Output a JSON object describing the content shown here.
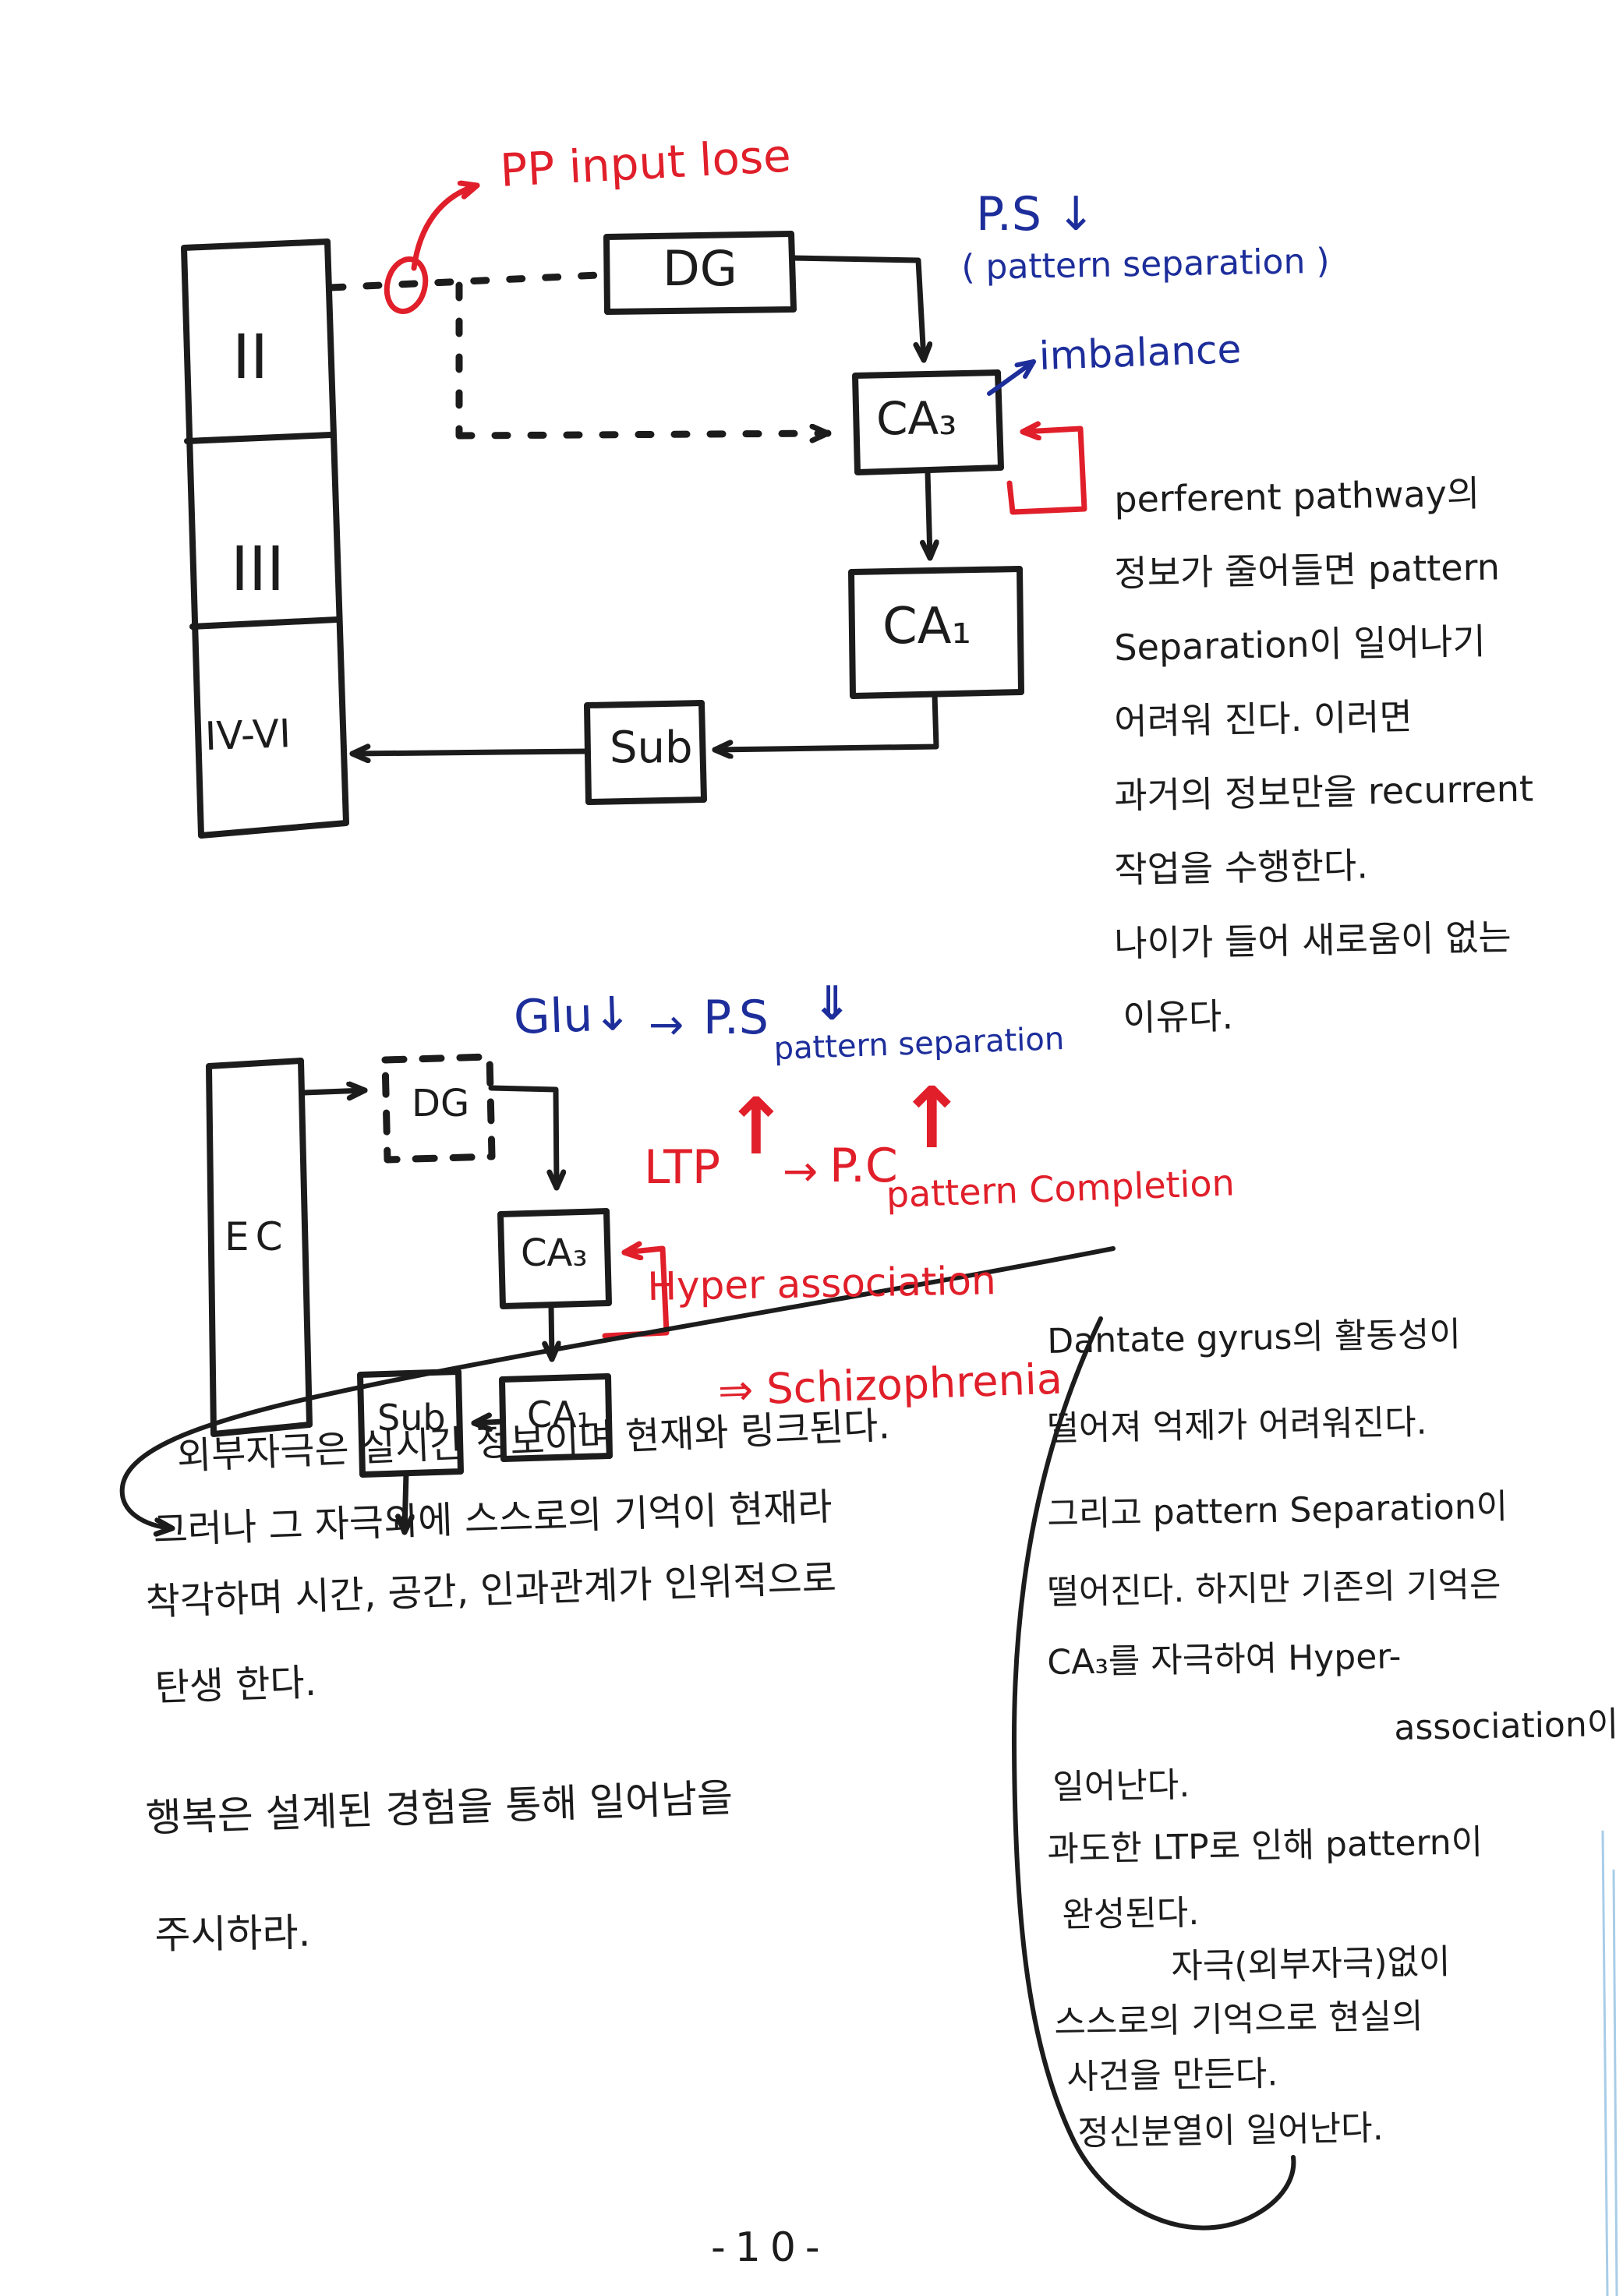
{
  "page": {
    "number": "-10-",
    "paper_color": "#ffffff",
    "ink_color": "#1c1c1c",
    "red_color": "#e01f2a",
    "blue_color": "#1d2e9b",
    "edge_line_color": "#a8cde8"
  },
  "diagram1": {
    "cortex_box": {
      "layer_2": "II",
      "layer_3": "III",
      "layer_4_6": "IV-VI"
    },
    "dg": "DG",
    "ca3": "CA₃",
    "ca1": "CA₁",
    "sub": "Sub",
    "pp_input_lose": "PP input lose",
    "ps_down": "P.S ↓",
    "pattern_separation_paren": "( pattern separation )",
    "imbalance": "imbalance"
  },
  "diagram2": {
    "ec": "EC",
    "dg": "DG",
    "ca3": "CA₃",
    "ca1": "CA₁",
    "sub": "Sub",
    "glu_down": "Glu↓",
    "arrow_right_1": "→",
    "ps": "P.S",
    "ps_double_down": "⇓",
    "pattern_separation_label": "pattern separation",
    "ltp": "LTP",
    "ltp_up_arrow": "↑",
    "arrow_right_2": "→",
    "pc": "P.C",
    "pc_up_arrow": "↑",
    "pattern_completion_label": "pattern Completion",
    "hyper_association": "Hyper association",
    "schizophrenia": "⇒ Schizophrenia"
  },
  "notes": {
    "right_top": [
      "perferent pathway의",
      "정보가 줄어들면 pattern",
      "Separation이 일어나기",
      "어려워 진다.   이러면",
      "과거의 정보만을 recurrent",
      "작업을 수행한다.",
      "나이가 들어 새로움이 없는",
      "이유다."
    ],
    "left_callout": [
      "외부자극은 실시간 정보이며 현재와 링크된다.",
      "그러나 그 자극외에 스스로의 기억이 현재라",
      "착각하며 시간, 공간, 인과관계가 인위적으로",
      "탄생 한다."
    ],
    "left_message": [
      "행복은 설계된 경험을 통해 일어남을",
      "주시하라."
    ],
    "right_bottom": [
      "Dantate gyrus의 활동성이",
      "떨어져 억제가 어려워진다.",
      "그리고 pattern Separation이",
      "떨어진다. 하지만 기존의 기억은",
      "CA₃를 자극하여 Hyper-",
      "association이",
      "일어난다.",
      "과도한 LTP로 인해 pattern이",
      "완성된다.",
      "자극(외부자극)없이",
      "스스로의 기억으로 현실의",
      "사건을 만든다.",
      "정신분열이 일어난다."
    ]
  }
}
